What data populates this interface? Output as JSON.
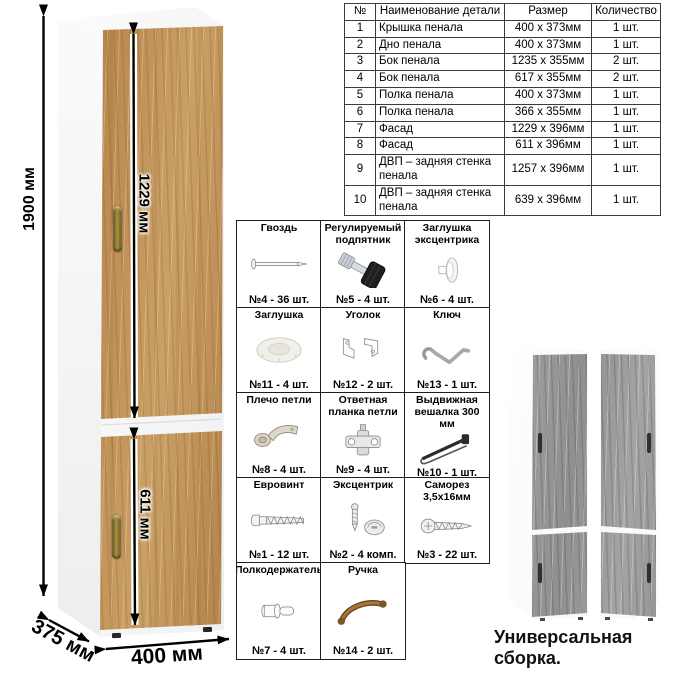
{
  "parts_table": {
    "headers": [
      "№",
      "Наименование детали",
      "Размер",
      "Количество"
    ],
    "rows": [
      {
        "num": "1",
        "name": "Крышка пенала",
        "size": "400 x 373мм",
        "qty": "1 шт."
      },
      {
        "num": "2",
        "name": "Дно пенала",
        "size": "400 x 373мм",
        "qty": "1 шт."
      },
      {
        "num": "3",
        "name": "Бок пенала",
        "size": "1235 x 355мм",
        "qty": "2 шт."
      },
      {
        "num": "4",
        "name": "Бок пенала",
        "size": "617 x 355мм",
        "qty": "2 шт."
      },
      {
        "num": "5",
        "name": "Полка пенала",
        "size": "400 x 373мм",
        "qty": "1 шт."
      },
      {
        "num": "6",
        "name": "Полка пенала",
        "size": "366 x 355мм",
        "qty": "1 шт."
      },
      {
        "num": "7",
        "name": "Фасад",
        "size": "1229 x 396мм",
        "qty": "1 шт."
      },
      {
        "num": "8",
        "name": "Фасад",
        "size": "611 x 396мм",
        "qty": "1 шт."
      },
      {
        "num": "9",
        "name": "ДВП – задняя стенка пенала",
        "size": "1257 x 396мм",
        "qty": "1 шт."
      },
      {
        "num": "10",
        "name": "ДВП – задняя стенка пенала",
        "size": "639 x 396мм",
        "qty": "1 шт."
      }
    ]
  },
  "hardware": {
    "items": [
      {
        "title": "Гвоздь",
        "count": "№4 - 36 шт.",
        "icon": "nail-icon"
      },
      {
        "title": "Регулируемый подпятник",
        "count": "№5 - 4 шт.",
        "icon": "adjustable-foot-icon"
      },
      {
        "title": "Заглушка эксцентрика",
        "count": "№6 - 4 шт.",
        "icon": "cam-cap-icon"
      },
      {
        "title": "Заглушка",
        "count": "№11 - 4 шт.",
        "icon": "cap-icon"
      },
      {
        "title": "Уголок",
        "count": "№12 - 2 шт.",
        "icon": "corner-bracket-icon"
      },
      {
        "title": "Ключ",
        "count": "№13 - 1 шт.",
        "icon": "hex-key-icon"
      },
      {
        "title": "Плечо петли",
        "count": "№8 - 4 шт.",
        "icon": "hinge-arm-icon"
      },
      {
        "title": "Ответная планка петли",
        "count": "№9 - 4 шт.",
        "icon": "hinge-plate-icon"
      },
      {
        "title": "Выдвижная вешалка 300 мм",
        "count": "№10 - 1 шт.",
        "icon": "pullout-hanger-icon"
      },
      {
        "title": "Евровинт",
        "count": "№1 - 12 шт.",
        "icon": "confirmat-screw-icon"
      },
      {
        "title": "Эксцентрик",
        "count": "№2 - 4 комп.",
        "icon": "cam-lock-icon"
      },
      {
        "title": "Саморез 3,5х16мм",
        "count": "№3 - 22 шт.",
        "icon": "self-tapping-screw-icon"
      },
      {
        "title": "Полкодержатель",
        "count": "№7 - 4 шт.",
        "icon": "shelf-pin-icon"
      },
      {
        "title": "Ручка",
        "count": "№14 - 2 шт.",
        "icon": "handle-icon"
      }
    ]
  },
  "dimensions": {
    "height": "1900 мм",
    "upper_door": "1229 мм",
    "lower_door": "611 мм",
    "width": "400 мм",
    "depth": "375 мм"
  },
  "caption": "Универсальная сборка.",
  "colors": {
    "wood": "#c2915a",
    "gray_wood": "#9a9a9a",
    "carcass": "#ffffff",
    "handle_bronze": "#8a6d3b",
    "line": "#1a1a1a"
  }
}
